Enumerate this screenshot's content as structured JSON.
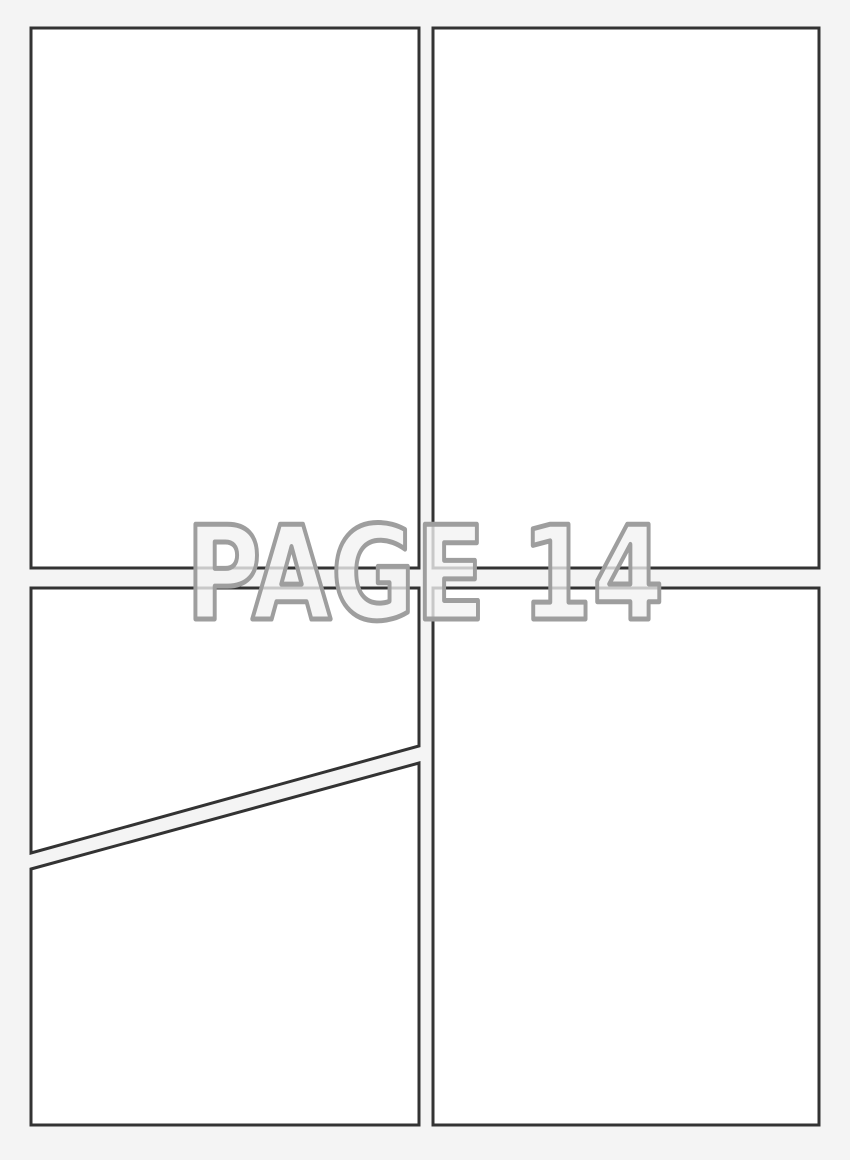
{
  "page_label": "PAGE 14",
  "colors": {
    "background": "#f4f4f4",
    "panel_fill": "#ffffff",
    "panel_border": "#333333",
    "label_fill": "#f2f2f2",
    "label_outline": "#9e9e9e"
  },
  "canvas": {
    "width": 850,
    "height": 1160
  },
  "panel_border_width": 3,
  "label_layout": {
    "x": 186,
    "baseline_y": 619,
    "font_size": 130,
    "text_length": 478,
    "outline_width": 5,
    "fill_opacity": 0.78
  },
  "panels": [
    {
      "id": "panel-top-left",
      "points": "31,28 419,28 419,568 31,568"
    },
    {
      "id": "panel-top-right",
      "points": "433,28 819,28 819,568 433,568"
    },
    {
      "id": "panel-bottom-left-upper",
      "points": "31,588 419,588 419,746 31,853"
    },
    {
      "id": "panel-bottom-left-lower",
      "points": "31,869 419,763 419,1125 31,1125"
    },
    {
      "id": "panel-bottom-right",
      "points": "433,588 819,588 819,1125 433,1125"
    }
  ]
}
